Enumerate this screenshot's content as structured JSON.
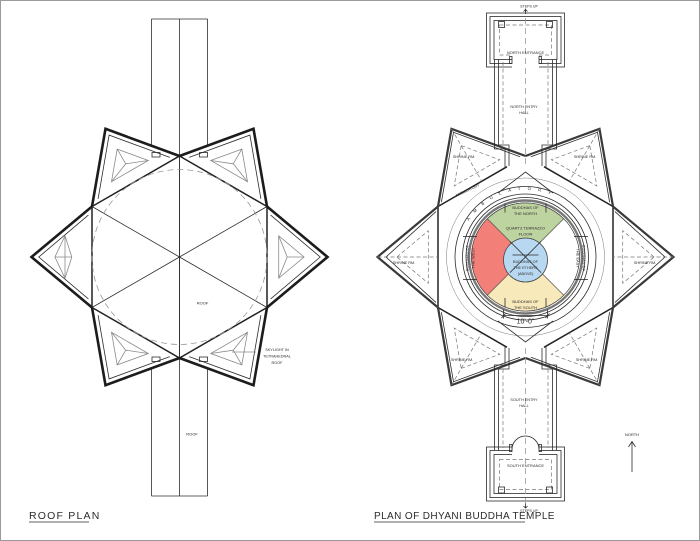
{
  "page": {
    "bg": "#ffffff",
    "border_color": "#9a9a9a",
    "line_color": "#2b2b2b"
  },
  "left_plan": {
    "title": "ROOF PLAN",
    "roof_label_center": "ROOF",
    "roof_label_lower": "ROOF",
    "skylight_note": [
      "SKYLIGHT IN",
      "TETRAHEDRAL",
      "ROOF"
    ]
  },
  "right_plan": {
    "title": "PLAN OF DHYANI BUDDHA TEMPLE",
    "north_arrow_label": "NORTH",
    "steps_up_top": "STEPS UP",
    "steps_up_bottom": "STEPS UP",
    "north_entrance": "NORTH ENTRANCE",
    "south_entrance": "SOUTH ENTRANCE",
    "north_entry_hall": [
      "NORTH ENTRY",
      "HALL"
    ],
    "south_entry_hall": [
      "SOUTH ENTRY",
      "HALL"
    ],
    "ambulatory_curved": "AMBULATORY",
    "ambulatory_diagonal": "AMBULATORY",
    "shrine_labels": [
      "SHRINE RM.",
      "SHRINE RM.",
      "SHRINE RM.",
      "SHRINE RM.",
      "SHRINE RM.",
      "SHRINE RM."
    ],
    "floor_label": [
      "QUARTZ TERRAZZO",
      "FLOOR"
    ],
    "dimension": "10'-0\"",
    "segments": {
      "north": {
        "label": [
          "BUDDHAS OF",
          "THE NORTH"
        ],
        "color": "#bdd3a0"
      },
      "west": {
        "label": [
          "BUDDHAS OF",
          "THE WEST"
        ],
        "color": "#f28079"
      },
      "east": {
        "label": [
          "BUDDHAS OF",
          "THE EAST"
        ],
        "color": "#ffffff"
      },
      "south": {
        "label": [
          "BUDDHAS OF",
          "THE SOUTH"
        ],
        "color": "#f7e9b9"
      },
      "center": {
        "label": [
          "BUDDHAS OF",
          "THE ETHERS",
          "(ABOVE)"
        ],
        "color": "#b8d8f1"
      }
    }
  }
}
